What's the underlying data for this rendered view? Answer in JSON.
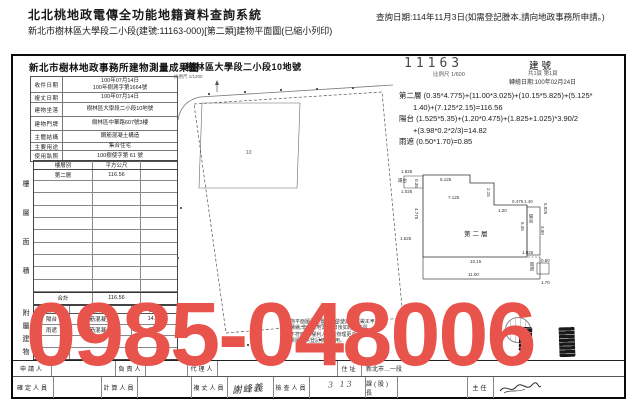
{
  "header": {
    "system_title": "北北桃地政電傳全功能地籍資料查詢系統",
    "query_date": "查詢日期:114年11月3日(如需登記謄本,請向地政事務所申請。)",
    "subtitle": "新北市樹林區大學段二小段(建號:11163-000)[第二類]建物平面圖(已縮小列印)"
  },
  "doc": {
    "title": "新北市樹林地政事務所建物測量成果圖",
    "parcel_title": "樹林區大學段二小段10地號",
    "building_no": "11163",
    "building_no_label": "建號",
    "scale_line": "比例尺 1/600",
    "sheet_line": "共1頁 第1頁",
    "redraw_date": "轉繪日期:100年02月24日"
  },
  "info_table": {
    "rows": [
      {
        "label": "收件日期",
        "value": "100年07月14日",
        "value2": "100年樹測字第1664號"
      },
      {
        "label": "複丈日期",
        "value": "100年07月14日",
        "value2": ""
      },
      {
        "label": "建物坐落",
        "value": "樹林區大學段二小段10地號",
        "value2": ""
      },
      {
        "label": "建物門牌",
        "value": "樹林區中華路607號3樓",
        "value2": ""
      },
      {
        "label": "主體結構",
        "value": "鋼筋混凝土構造",
        "value2": ""
      },
      {
        "label": "主要用途",
        "value": "集合住宅",
        "value2": ""
      },
      {
        "label": "使用執照",
        "value": "100樹使字第 61 號",
        "value2": ""
      }
    ]
  },
  "floor_table": {
    "side_label": "樓層面積",
    "col_floor": "樓層別",
    "col_area": "平方公尺",
    "floor": "第二層",
    "area": "116.56",
    "total_label": "合計",
    "total_area": "116.56"
  },
  "annex_table": {
    "side_label": "附屬建物",
    "col_use": "用途",
    "col_structure": "主要建材",
    "col_area": "面積",
    "rows": [
      {
        "use": "陽台",
        "structure": "鋼筋混凝土造",
        "area": "14.82"
      },
      {
        "use": "雨遮",
        "structure": "鋼筋混凝土造",
        "area": "0.85"
      }
    ]
  },
  "calc": {
    "lines": [
      "第二層 (0.35*4.775)+(11.00*3.025)+(10.15*5.825)+(5.125*",
      "1.40)+(7.125*2.15)=116.56",
      "陽台 (1.525*5.35)+(1.20*0.475)+(1.825+1.025)*3.90/2",
      "+(3.98*0.2*2/3)=14.82",
      "雨遮 (0.50*1.70)=0.85"
    ]
  },
  "site_plan": {
    "scale_note": "比例尺 1/1200",
    "lot_number": "10"
  },
  "floor_plan": {
    "room": "第二層",
    "balcony_left": "陽台",
    "balcony_right": "陽台",
    "canopy": "雨遮",
    "dims": {
      "d1825": "1.825",
      "d1025a": "1.025",
      "d5125": "5.125",
      "d7125": "7.125",
      "d215": "2.15",
      "d140": "1.40",
      "d5825": "5.825",
      "d535": "5.35",
      "d1025b": "1.025",
      "d1015": "10.15",
      "d1100": "11.00",
      "d035": "0.35",
      "d4775": "4.775",
      "d1525": "1.525",
      "d390": "3.90",
      "d050": "0.50",
      "d170": "1.70",
      "d0475": "0.475",
      "d120": "1.20"
    }
  },
  "notes": {
    "lines": [
      "本建物平面圖及位置圖係依使用執照竣工平",
      "面圖轉繪,非經實地測量,日後如經複丈與",
      "現況不符時,由權利人依法辦理更正。",
      "本成果圖僅供登記參考使用。"
    ]
  },
  "footer": {
    "applicant_label": "申請人",
    "principal_label": "負責人",
    "agent_label": "代理人",
    "address_label": "住址",
    "address_value": "新北市…一段",
    "confirm_label": "確定人員",
    "calc_label": "計算人員",
    "survey_label": "複丈人員",
    "survey_sig": "謝峰義",
    "check_label": "檢查人員",
    "chief_label": "課(股)長",
    "director_label": "主任",
    "pencil_note": "3 13"
  },
  "watermark": {
    "text": "0985-048006",
    "color": "#e8534c"
  }
}
